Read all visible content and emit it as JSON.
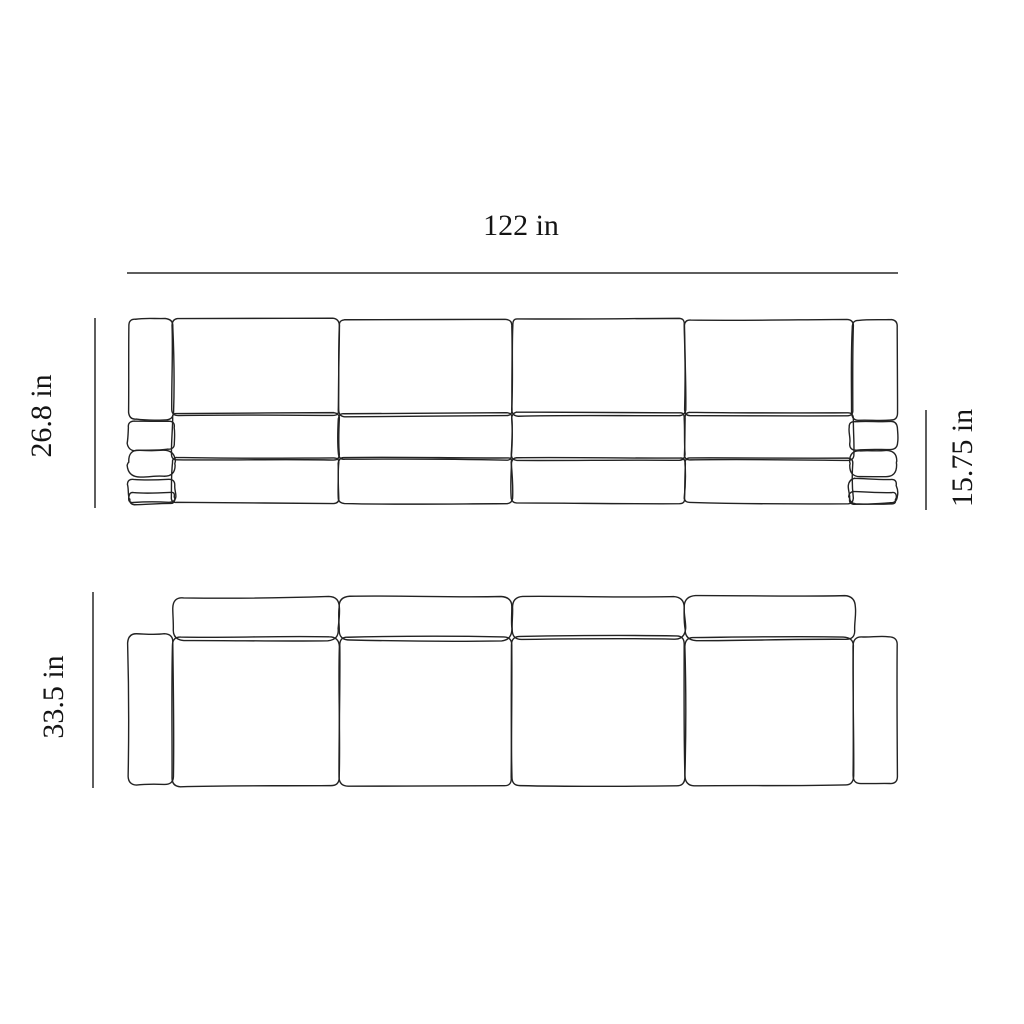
{
  "dimensions": {
    "width": {
      "value": 122,
      "unit": "in",
      "label": "122 in"
    },
    "height": {
      "value": 26.8,
      "unit": "in",
      "label": "26.8 in"
    },
    "seat_height": {
      "value": 15.75,
      "unit": "in",
      "label": "15.75 in"
    },
    "depth": {
      "value": 33.5,
      "unit": "in",
      "label": "33.5 in"
    }
  },
  "colors": {
    "background": "#ffffff",
    "sketch_line": "#222222",
    "dimension_line": "#5e5e5e",
    "label_text": "#141414"
  }
}
